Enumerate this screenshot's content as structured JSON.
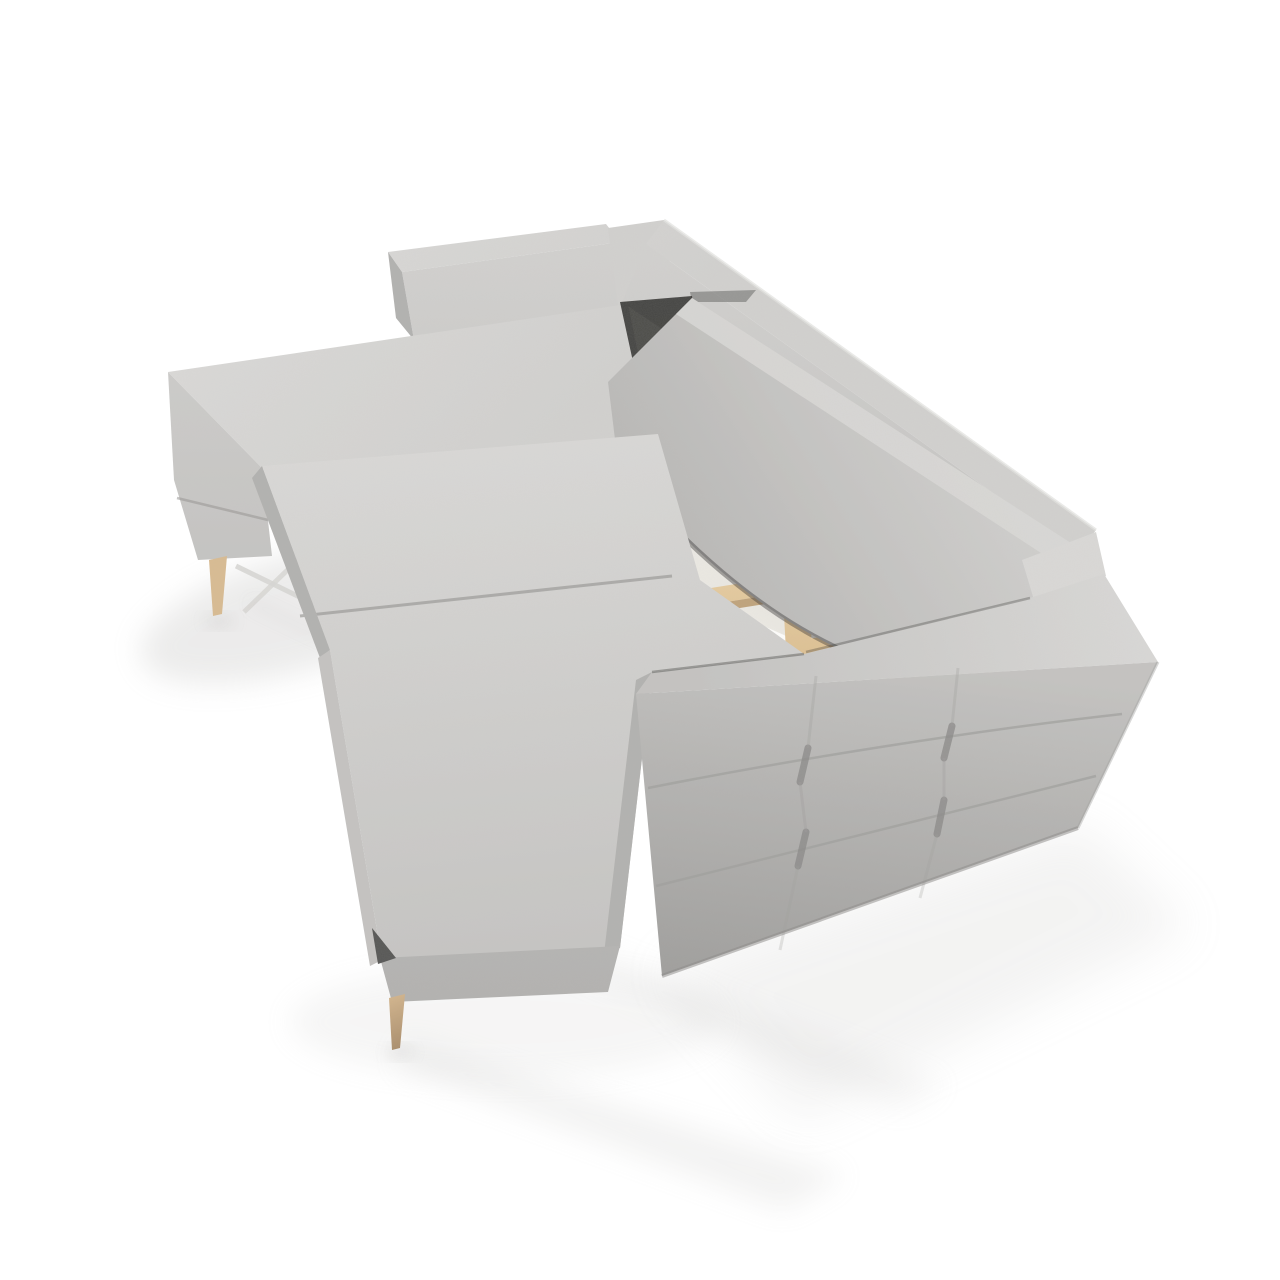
{
  "image": {
    "kind": "product-photo",
    "subject": "light grey corner sofa bed unfolded into a bed, open storage compartment with wooden frame, tufted side panel, wooden legs",
    "background": "#ffffff"
  },
  "colors": {
    "background": "#ffffff",
    "fabric_highlight": "#e3e2e0",
    "fabric_light": "#d9d8d6",
    "fabric_top": "#d1d0ce",
    "fabric_mid": "#c4c3c1",
    "fabric_shaded": "#b3b2b0",
    "fabric_dark": "#a09f9d",
    "fabric_deep": "#8b8a88",
    "seam": "#979694",
    "crevice": "#2f2e2c",
    "gap_shadow": "#6a6967",
    "wood_light": "#f0ddb7",
    "wood_mid": "#dcbf92",
    "wood_dark": "#bb9c72",
    "leg_light": "#d8bb93",
    "leg_dark": "#9f8363",
    "box_light": "#f8f7f3",
    "box_mid": "#eceae5",
    "box_shadow": "#e0ddd6",
    "box_bright": "#fdfcfa",
    "metal": "#d7d6d4",
    "floor_shadow": "#bcbbb9",
    "handle_dark": "#595856"
  },
  "parts": {
    "floor_shadow": "soft floor shadow",
    "chaise_backrest": "chaise backrest slab",
    "back_rail": "rear backrest rail",
    "back_cushion": "long back cushion",
    "chaise": "chaise lounge section",
    "wooden_leg": "tapered wooden leg",
    "metal_frame": "pull-out metal frame",
    "storage_box": "open storage compartment",
    "wood_frame": "pine wood frame slats",
    "bed_mattress": "pull-out bed mattresses",
    "armrest": "armrest",
    "tufted_panel": "tufted outer side panel"
  }
}
